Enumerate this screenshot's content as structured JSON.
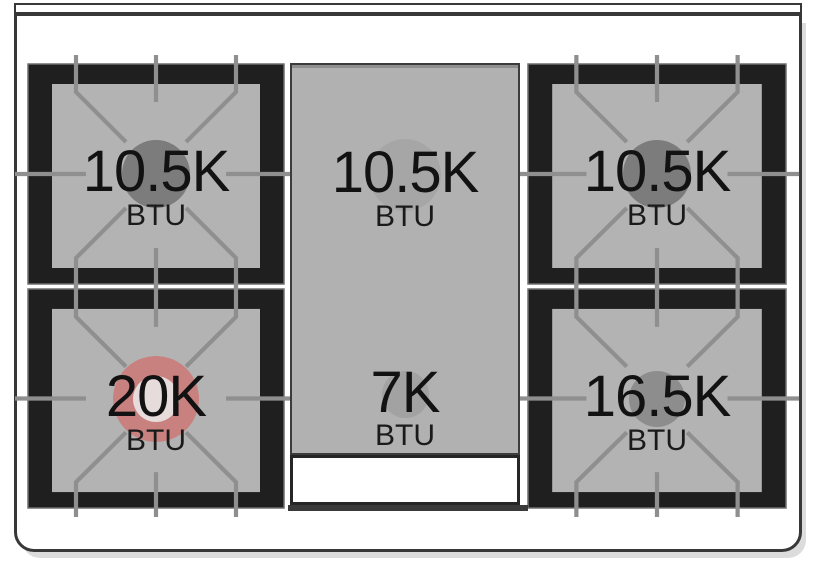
{
  "cooktop": {
    "burners": [
      {
        "id": "top-left",
        "power": "10.5K",
        "unit": "BTU",
        "flame_color": "#7c7c7c"
      },
      {
        "id": "top-center-griddle",
        "power": "10.5K",
        "unit": "BTU",
        "flame_color": "#a6a6a6"
      },
      {
        "id": "top-right",
        "power": "10.5K",
        "unit": "BTU",
        "flame_color": "#7c7c7c"
      },
      {
        "id": "bottom-left",
        "power": "20K",
        "unit": "BTU",
        "flame_color": "#c98180",
        "flame_inner_color": "#e5dcdb"
      },
      {
        "id": "bottom-center-griddle",
        "power": "7K",
        "unit": "BTU",
        "flame_color": "#a2a2a2"
      },
      {
        "id": "bottom-right",
        "power": "16.5K",
        "unit": "BTU",
        "flame_color": "#8d8d8d"
      }
    ],
    "colors": {
      "grate_black": "#1f1f1f",
      "surface_gray": "#b3b3b3",
      "griddle_gray": "#b1b1b1",
      "grate_line_gray": "#8f8f8f",
      "accent_red": "#c98180",
      "frame_outline": "#383838",
      "text": "#121212"
    }
  }
}
